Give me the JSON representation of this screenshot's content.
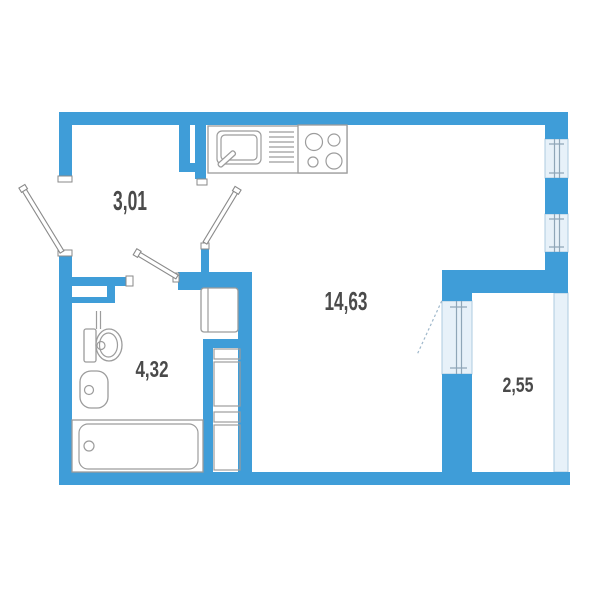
{
  "rooms": {
    "hallway": {
      "area": "3,01"
    },
    "living": {
      "area": "14,63"
    },
    "bathroom": {
      "area": "4,32"
    },
    "balcony": {
      "area": "2,55"
    }
  },
  "colors": {
    "wall": "#3F9DD8",
    "window_fill": "#E7F1F9",
    "window_border": "#AECBE0",
    "fixture_outline": "#9C9C9C",
    "label_text": "#4A4A4A",
    "background": "#FFFFFF"
  }
}
